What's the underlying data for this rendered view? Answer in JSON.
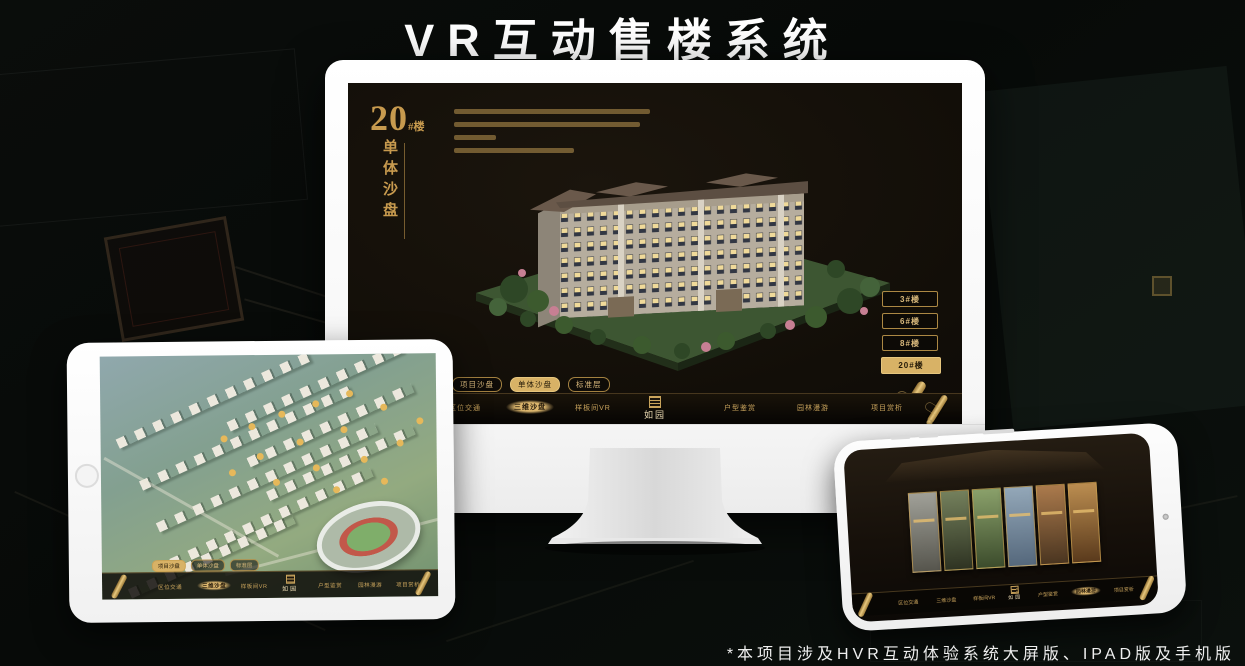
{
  "page": {
    "title": "VR互动售楼系统",
    "footer_note": "*本项目涉及HVR互动体验系统大屏版、IPAD版及手机版"
  },
  "colors": {
    "gold": "#c9a050",
    "gold_active": "#d8b266",
    "screen_bg": "#17120c",
    "text_gold": "#d9b97c"
  },
  "monitor": {
    "screen": {
      "floor_number": "20",
      "floor_suffix": "#楼",
      "vertical_title": "单体沙盘",
      "floor_buttons": [
        {
          "label": "3#楼"
        },
        {
          "label": "6#楼"
        },
        {
          "label": "8#楼"
        },
        {
          "label": "20#楼"
        }
      ],
      "active_floor": "20#楼",
      "tabs": [
        {
          "label": "项目沙盘"
        },
        {
          "label": "单体沙盘"
        },
        {
          "label": "标准层"
        }
      ],
      "active_tab": "单体沙盘",
      "nav": [
        {
          "label": "区位交通"
        },
        {
          "label": "三维沙盘"
        },
        {
          "label": "样板间VR"
        },
        {
          "label": "户型鉴赏"
        },
        {
          "label": "园林漫游"
        },
        {
          "label": "项目赏析"
        }
      ],
      "active_nav": "三维沙盘",
      "logo_text": "如园"
    }
  },
  "tablet": {
    "tabs": [
      {
        "label": "项目沙盘"
      },
      {
        "label": "单体沙盘"
      },
      {
        "label": "标准层"
      }
    ],
    "active_tab": "项目沙盘",
    "nav": [
      {
        "label": "区位交通"
      },
      {
        "label": "三维沙盘"
      },
      {
        "label": "样板间VR"
      },
      {
        "label": "户型鉴赏"
      },
      {
        "label": "园林漫游"
      },
      {
        "label": "项目赏析"
      }
    ],
    "active_nav": "三维沙盘",
    "logo_text": "如园"
  },
  "phone": {
    "nav": [
      {
        "label": "区位交通"
      },
      {
        "label": "三维沙盘"
      },
      {
        "label": "样板间VR"
      },
      {
        "label": "户型鉴赏"
      },
      {
        "label": "园林漫游"
      },
      {
        "label": "项目赏析"
      }
    ],
    "active_nav": "园林漫游",
    "logo_text": "如园"
  }
}
